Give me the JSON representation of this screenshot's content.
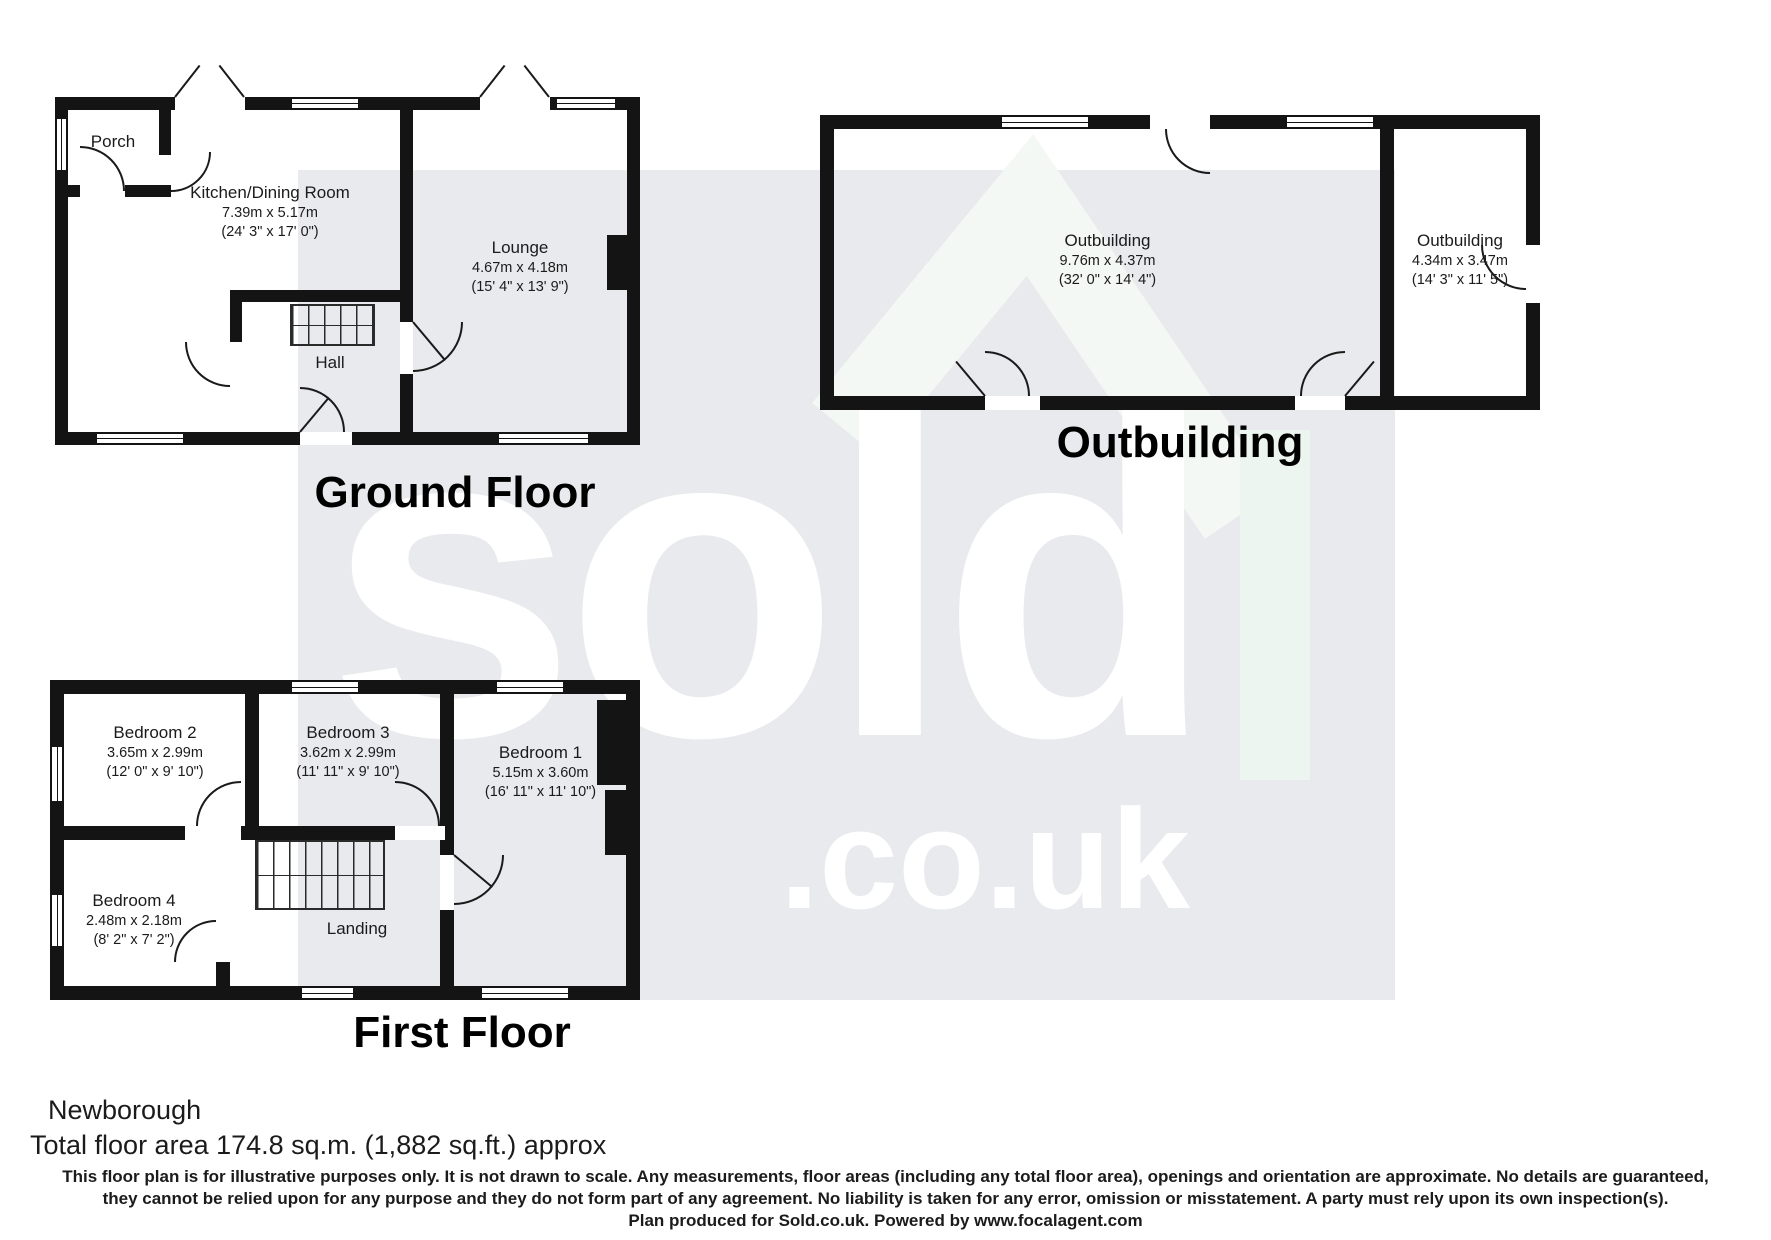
{
  "watermark": {
    "word": "sold",
    "suffix": ".co.uk"
  },
  "ground_floor": {
    "title": "Ground Floor",
    "rooms": {
      "porch": {
        "name": "Porch"
      },
      "kitchen": {
        "name": "Kitchen/Dining Room",
        "metric": "7.39m x 5.17m",
        "imperial": "(24' 3\" x 17' 0\")"
      },
      "lounge": {
        "name": "Lounge",
        "metric": "4.67m x 4.18m",
        "imperial": "(15' 4\" x 13' 9\")"
      },
      "hall": {
        "name": "Hall"
      }
    }
  },
  "outbuilding": {
    "title": "Outbuilding",
    "rooms": {
      "left": {
        "name": "Outbuilding",
        "metric": "9.76m x 4.37m",
        "imperial": "(32' 0\" x 14' 4\")"
      },
      "right": {
        "name": "Outbuilding",
        "metric": "4.34m x 3.47m",
        "imperial": "(14' 3\" x 11' 5\")"
      }
    }
  },
  "first_floor": {
    "title": "First Floor",
    "rooms": {
      "bedroom1": {
        "name": "Bedroom 1",
        "metric": "5.15m x 3.60m",
        "imperial": "(16' 11\" x 11' 10\")"
      },
      "bedroom2": {
        "name": "Bedroom 2",
        "metric": "3.65m x 2.99m",
        "imperial": "(12' 0\" x 9' 10\")"
      },
      "bedroom3": {
        "name": "Bedroom 3",
        "metric": "3.62m x 2.99m",
        "imperial": "(11' 11\" x 9' 10\")"
      },
      "bedroom4": {
        "name": "Bedroom 4",
        "metric": "2.48m x 2.18m",
        "imperial": "(8' 2\" x 7' 2\")"
      },
      "landing": {
        "name": "Landing"
      }
    }
  },
  "footer": {
    "address": "Newborough",
    "total_area": "Total floor area 174.8 sq.m. (1,882 sq.ft.) approx",
    "disclaimer_line1": "This floor plan is for illustrative purposes only. It is not drawn to scale. Any measurements, floor areas (including any total floor area), openings and orientation are approximate. No details are guaranteed,",
    "disclaimer_line2": "they cannot be relied upon for any purpose and they do not form part of any agreement. No liability is taken for any error, omission or misstatement. A party must rely upon its own inspection(s).",
    "credit": "Plan produced for Sold.co.uk. Powered by www.focalagent.com"
  },
  "colors": {
    "wall": "#141414",
    "watermark_bg": "#e8eaed",
    "watermark_text": "#ffffff",
    "watermark_roof": "#f3f8f4"
  }
}
